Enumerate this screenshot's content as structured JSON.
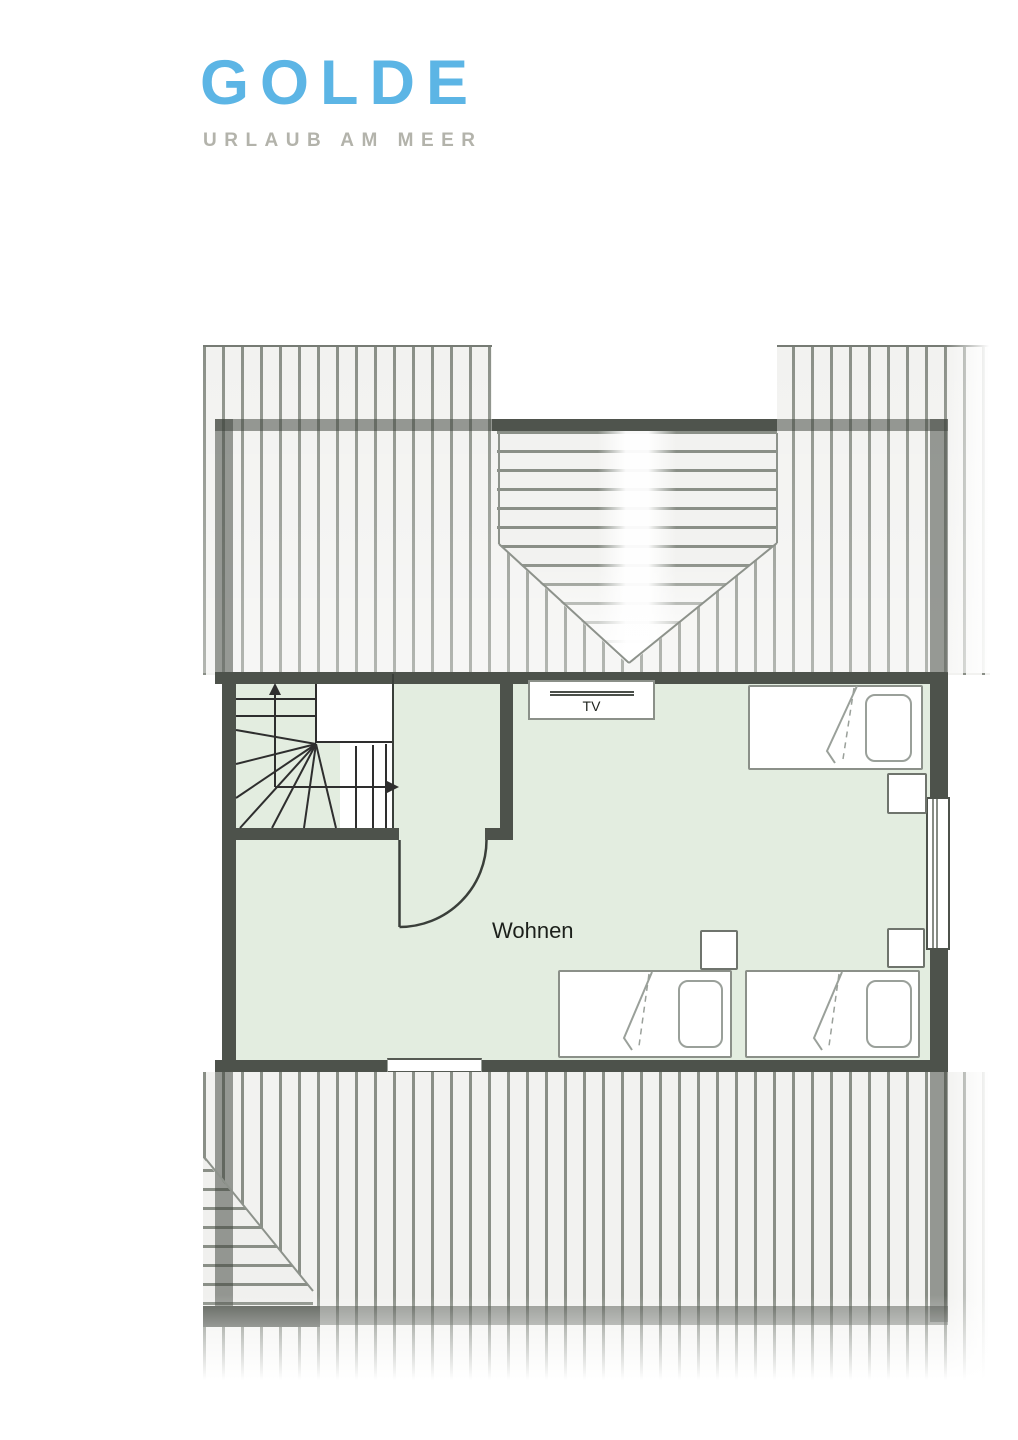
{
  "logo": {
    "initial": "G",
    "name": "GOLDE",
    "tagline": "URLAUB AM MEER"
  },
  "floor_plan": {
    "room_label": "Wohnen",
    "tv_label": "TV"
  },
  "colors": {
    "brand_pink": "#f0156b",
    "brand_blue": "#5cb5e5",
    "tagline_gray": "#b3b3ab",
    "wall_dark": "#4d524b",
    "floor_green": "#e3ede0",
    "hatch_line": "#8a8f87",
    "hatch_bg": "#f2f2f0"
  },
  "elements": {
    "staircase": "winder-staircase",
    "door": "door-to-living-room",
    "windows": 2,
    "beds": 3,
    "nightstands": 3,
    "tv": "tv-board",
    "roof": "attic-roof-hatching-with-dormer"
  }
}
